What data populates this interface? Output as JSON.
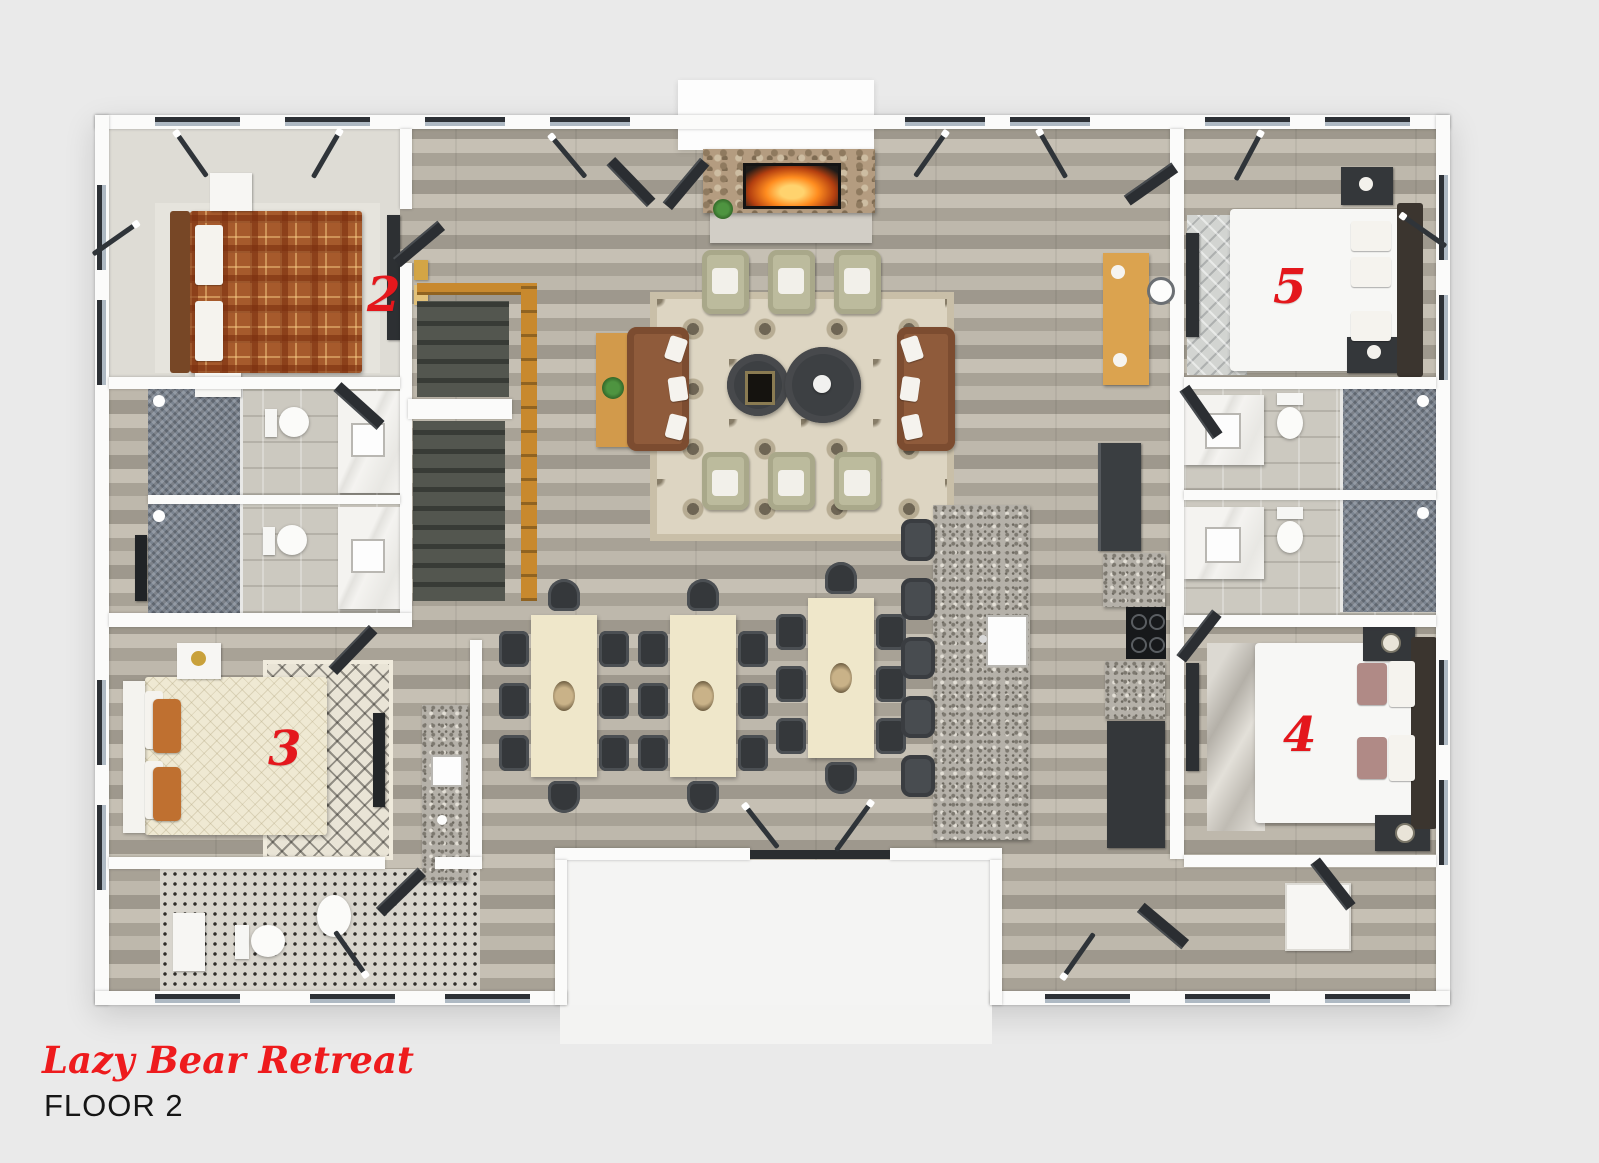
{
  "meta": {
    "property_name": "Lazy Bear Retreat",
    "floor_label": "FLOOR 2"
  },
  "palette": {
    "background": "#e9e9e9",
    "label_red": "#e8191c",
    "title_red": "#ee1b1d",
    "wall_white": "#fbfbfa",
    "wood_floor": "#b3ada1",
    "window_frame": "#2d3136",
    "window_glass": "#aeb9c3",
    "sofa_leather_brown": "#8f5b3b",
    "armchair_sage": "#bcbb9d",
    "dining_table_cream": "#efe7ca",
    "chair_charcoal": "#35383b",
    "granite_counter": "#b5b1a9",
    "stair_wood": "#c8892e",
    "bed2_plaid_orange": "#a65a2c",
    "bed3_pillow_orange": "#bf7030",
    "bed4_pillow_mauve": "#b08a86"
  },
  "rooms": [
    {
      "id": "bedroom-2",
      "label": "2"
    },
    {
      "id": "bedroom-3",
      "label": "3"
    },
    {
      "id": "bedroom-4",
      "label": "4"
    },
    {
      "id": "bedroom-5",
      "label": "5"
    }
  ]
}
